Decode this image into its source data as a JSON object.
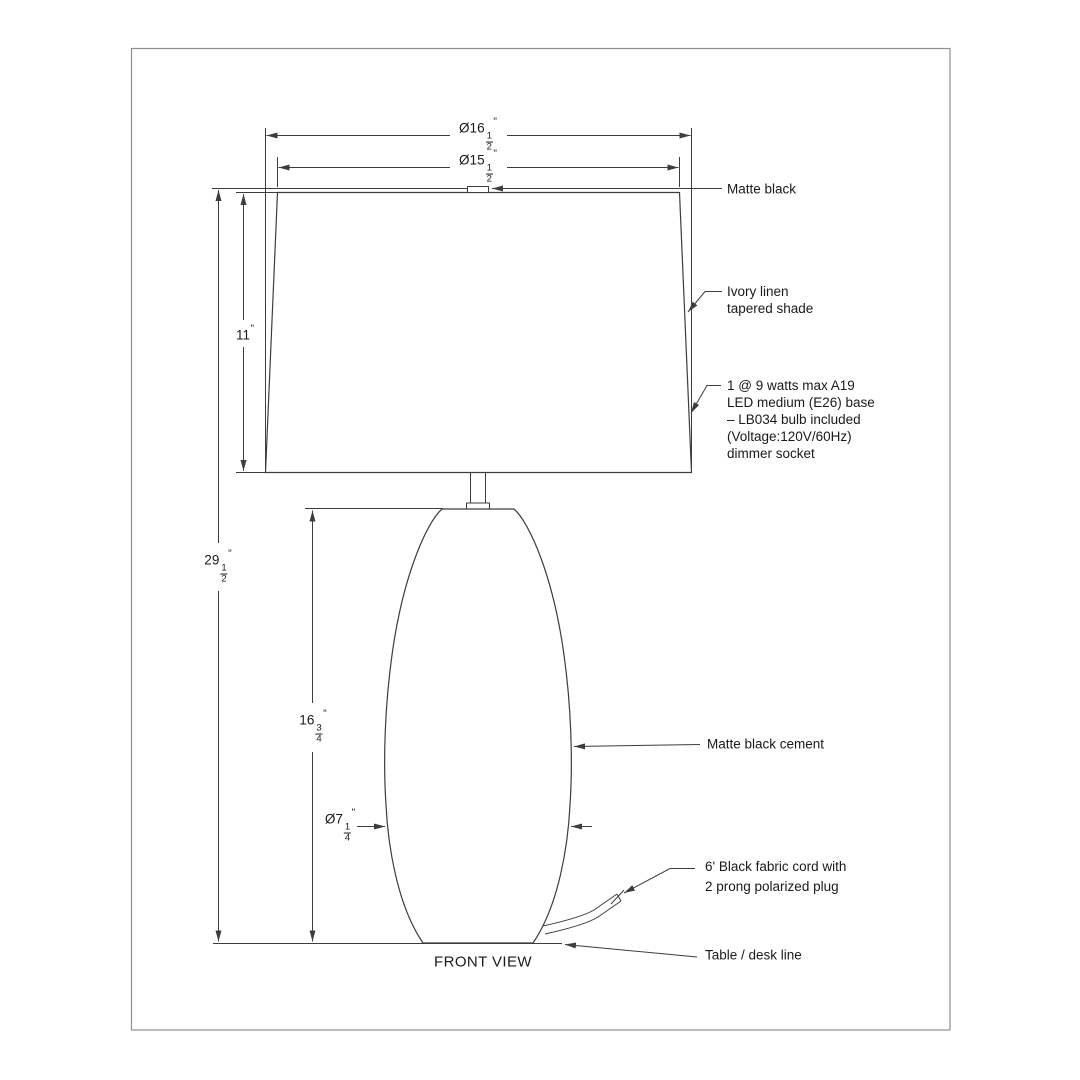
{
  "page": {
    "view_label": "FRONT VIEW"
  },
  "colors": {
    "line": "#3d3d3d",
    "border": "#8f8f8f",
    "text": "#1a1a1a",
    "background": "#ffffff"
  },
  "dimensions": {
    "shade_bottom_diameter": {
      "prefix": "Ø16",
      "num": "1",
      "den": "2",
      "unit": "\""
    },
    "shade_top_diameter": {
      "prefix": "Ø15",
      "num": "1",
      "den": "2",
      "unit": "\""
    },
    "shade_height": {
      "value": "11",
      "unit": "\""
    },
    "overall_height": {
      "prefix": "29",
      "num": "1",
      "den": "2",
      "unit": "\""
    },
    "body_height": {
      "prefix": "16",
      "num": "3",
      "den": "4",
      "unit": "\""
    },
    "body_diameter": {
      "prefix": "Ø7",
      "num": "1",
      "den": "4",
      "unit": "\""
    }
  },
  "callouts": {
    "finial": "Matte black",
    "shade_line1": "Ivory linen",
    "shade_line2": "tapered shade",
    "bulb_line1": "1 @ 9 watts max A19",
    "bulb_line2": "LED medium (E26) base",
    "bulb_line3": "– LB034 bulb included",
    "bulb_line4": "(Voltage:120V/60Hz)",
    "bulb_line5": "dimmer socket",
    "body": "Matte black cement",
    "cord_line1": "6' Black fabric cord with",
    "cord_line2": "2 prong polarized plug",
    "table": "Table / desk line"
  }
}
